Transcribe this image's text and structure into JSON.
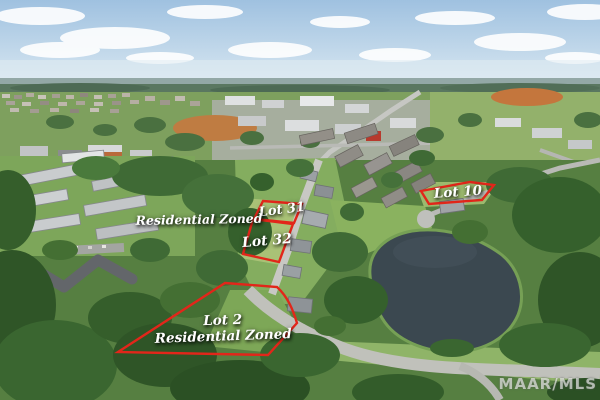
{
  "scene": {
    "kind": "aerial drone photograph",
    "features": "suburban neighborhood with pond, apartment complex, wooded residential lots, commercial area near horizon"
  },
  "annotations": {
    "outline_color": "#e2261a",
    "text_color": "#ffffff",
    "zone_label_left": "Residential Zoned",
    "lots": {
      "lot31": "Lot 31",
      "lot32": "Lot 32",
      "lot10": "Lot 10",
      "lot2_title": "Lot 2",
      "lot2_subtitle": "Residential Zoned"
    }
  },
  "watermark": "MAAR/MLS"
}
